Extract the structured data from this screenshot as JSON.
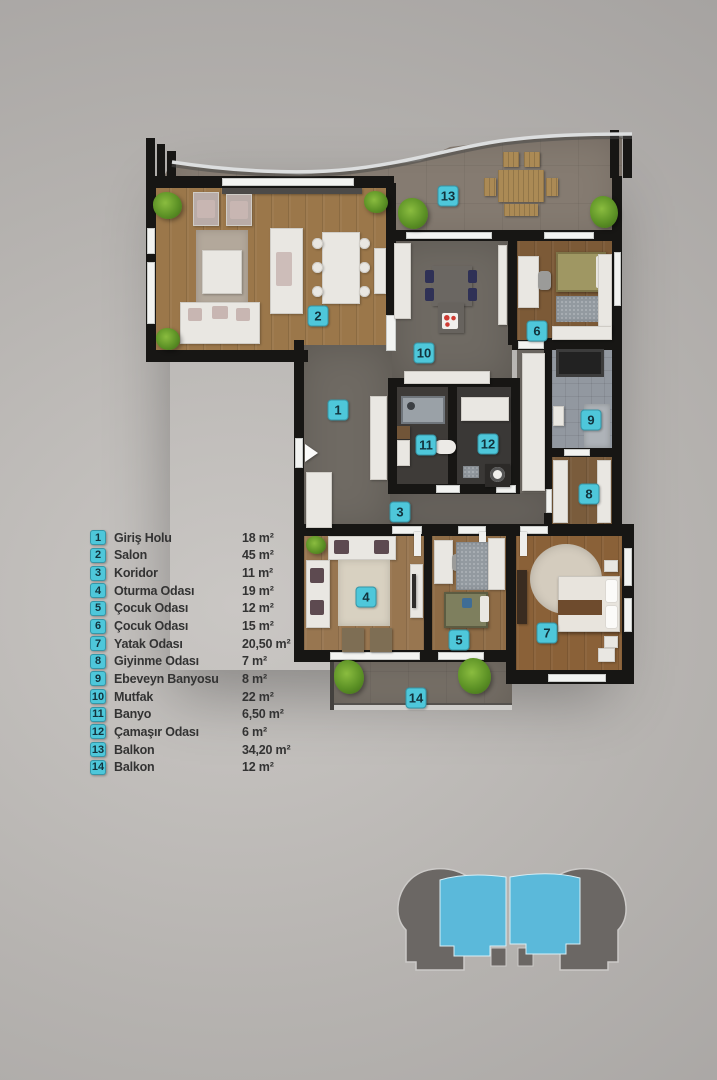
{
  "colors": {
    "accent": "#4ec7da",
    "badge_text": "#12333d",
    "legend_text": "#333333",
    "footprint_gray": "#6b6764",
    "footprint_blue": "#5bb9da"
  },
  "legend": {
    "items": [
      {
        "n": "1",
        "label": "Giriş Holu",
        "area": "18 m²"
      },
      {
        "n": "2",
        "label": "Salon",
        "area": "45 m²"
      },
      {
        "n": "3",
        "label": "Koridor",
        "area": "11 m²"
      },
      {
        "n": "4",
        "label": "Oturma Odası",
        "area": "19 m²"
      },
      {
        "n": "5",
        "label": "Çocuk Odası",
        "area": "12 m²"
      },
      {
        "n": "6",
        "label": "Çocuk Odası",
        "area": "15 m²"
      },
      {
        "n": "7",
        "label": "Yatak Odası",
        "area": "20,50 m²"
      },
      {
        "n": "8",
        "label": "Giyinme Odası",
        "area": "7 m²"
      },
      {
        "n": "9",
        "label": "Ebeveyn Banyosu",
        "area": "8 m²"
      },
      {
        "n": "10",
        "label": "Mutfak",
        "area": "22 m²"
      },
      {
        "n": "11",
        "label": "Banyo",
        "area": "6,50 m²"
      },
      {
        "n": "12",
        "label": "Çamaşır Odası",
        "area": "6 m²"
      },
      {
        "n": "13",
        "label": "Balkon",
        "area": "34,20 m²"
      },
      {
        "n": "14",
        "label": "Balkon",
        "area": "12 m²"
      }
    ]
  },
  "plan": {
    "badges": [
      {
        "n": "1",
        "x": 338,
        "y": 410
      },
      {
        "n": "2",
        "x": 318,
        "y": 316
      },
      {
        "n": "3",
        "x": 400,
        "y": 512
      },
      {
        "n": "4",
        "x": 366,
        "y": 597
      },
      {
        "n": "5",
        "x": 459,
        "y": 640
      },
      {
        "n": "6",
        "x": 537,
        "y": 331
      },
      {
        "n": "7",
        "x": 547,
        "y": 633
      },
      {
        "n": "8",
        "x": 589,
        "y": 494
      },
      {
        "n": "9",
        "x": 591,
        "y": 420
      },
      {
        "n": "10",
        "x": 424,
        "y": 353
      },
      {
        "n": "11",
        "x": 426,
        "y": 445
      },
      {
        "n": "12",
        "x": 488,
        "y": 444
      },
      {
        "n": "13",
        "x": 448,
        "y": 196
      },
      {
        "n": "14",
        "x": 416,
        "y": 698
      }
    ]
  }
}
